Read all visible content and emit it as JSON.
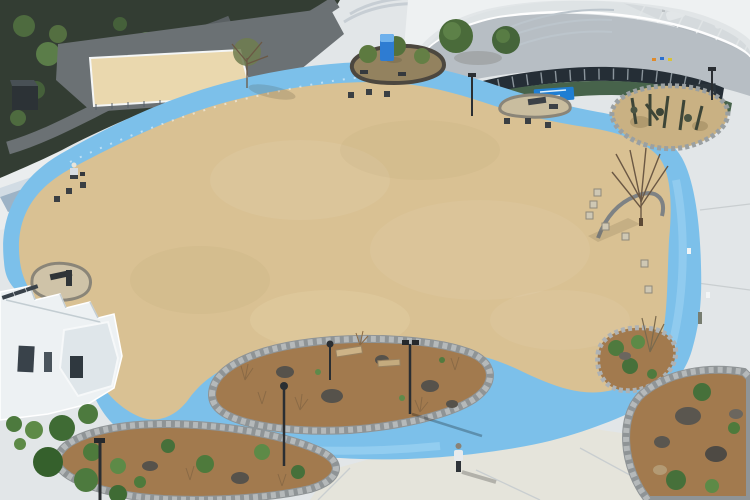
{
  "scene": {
    "type": "aerial-park-photo",
    "summary": "Drone view of a park plaza: large oval sand field ringed by a sky-blue walking path, concrete plaza, curved-roof sports hall with parking at top right, wooded hillside with retaining wall and sand court at top left, white restroom building at bottom left, rock-bordered planting islands with mulch, boulders, shrubs, benches and lamp posts, scattered cube seats, two visitors.",
    "people_count": 3,
    "vehicle_count": 4
  },
  "colors": {
    "pavement": "#e2e6e8",
    "pavementBright": "#f1f3f3",
    "pavementWarm": "#e8e2d2",
    "sand": "#d9c193",
    "sandLight": "#e6d3a9",
    "path": "#7cc0ea",
    "pathLight": "#a8d9f6",
    "hill": "#333d33",
    "road": "#6b7174",
    "wallFace": "#9db3c6",
    "wallTop": "#d2dce4",
    "court": "#ead8ae",
    "parking": "#b3bac0",
    "roof": "#eef1f2",
    "roofShade": "#dde2e4",
    "facade": "#b7bec4",
    "windowDark": "#252e36",
    "turf": "#47634b",
    "banner": "#1f7ed3",
    "buildingWhite": "#edf1f3",
    "mulch": "#a27a4e",
    "rockBorder": "#b5b9ba",
    "boulder": "#56524b",
    "shrub": "#4e7a3c",
    "stoneIsland": "#93825f",
    "cactiBase": "#c9b183",
    "plantDark": "#3d4537",
    "lamp": "#2a2e32",
    "toilet": "#2e7cd2",
    "cubeDark": "#3a3f43",
    "cubeLight": "#cfc8b4"
  }
}
